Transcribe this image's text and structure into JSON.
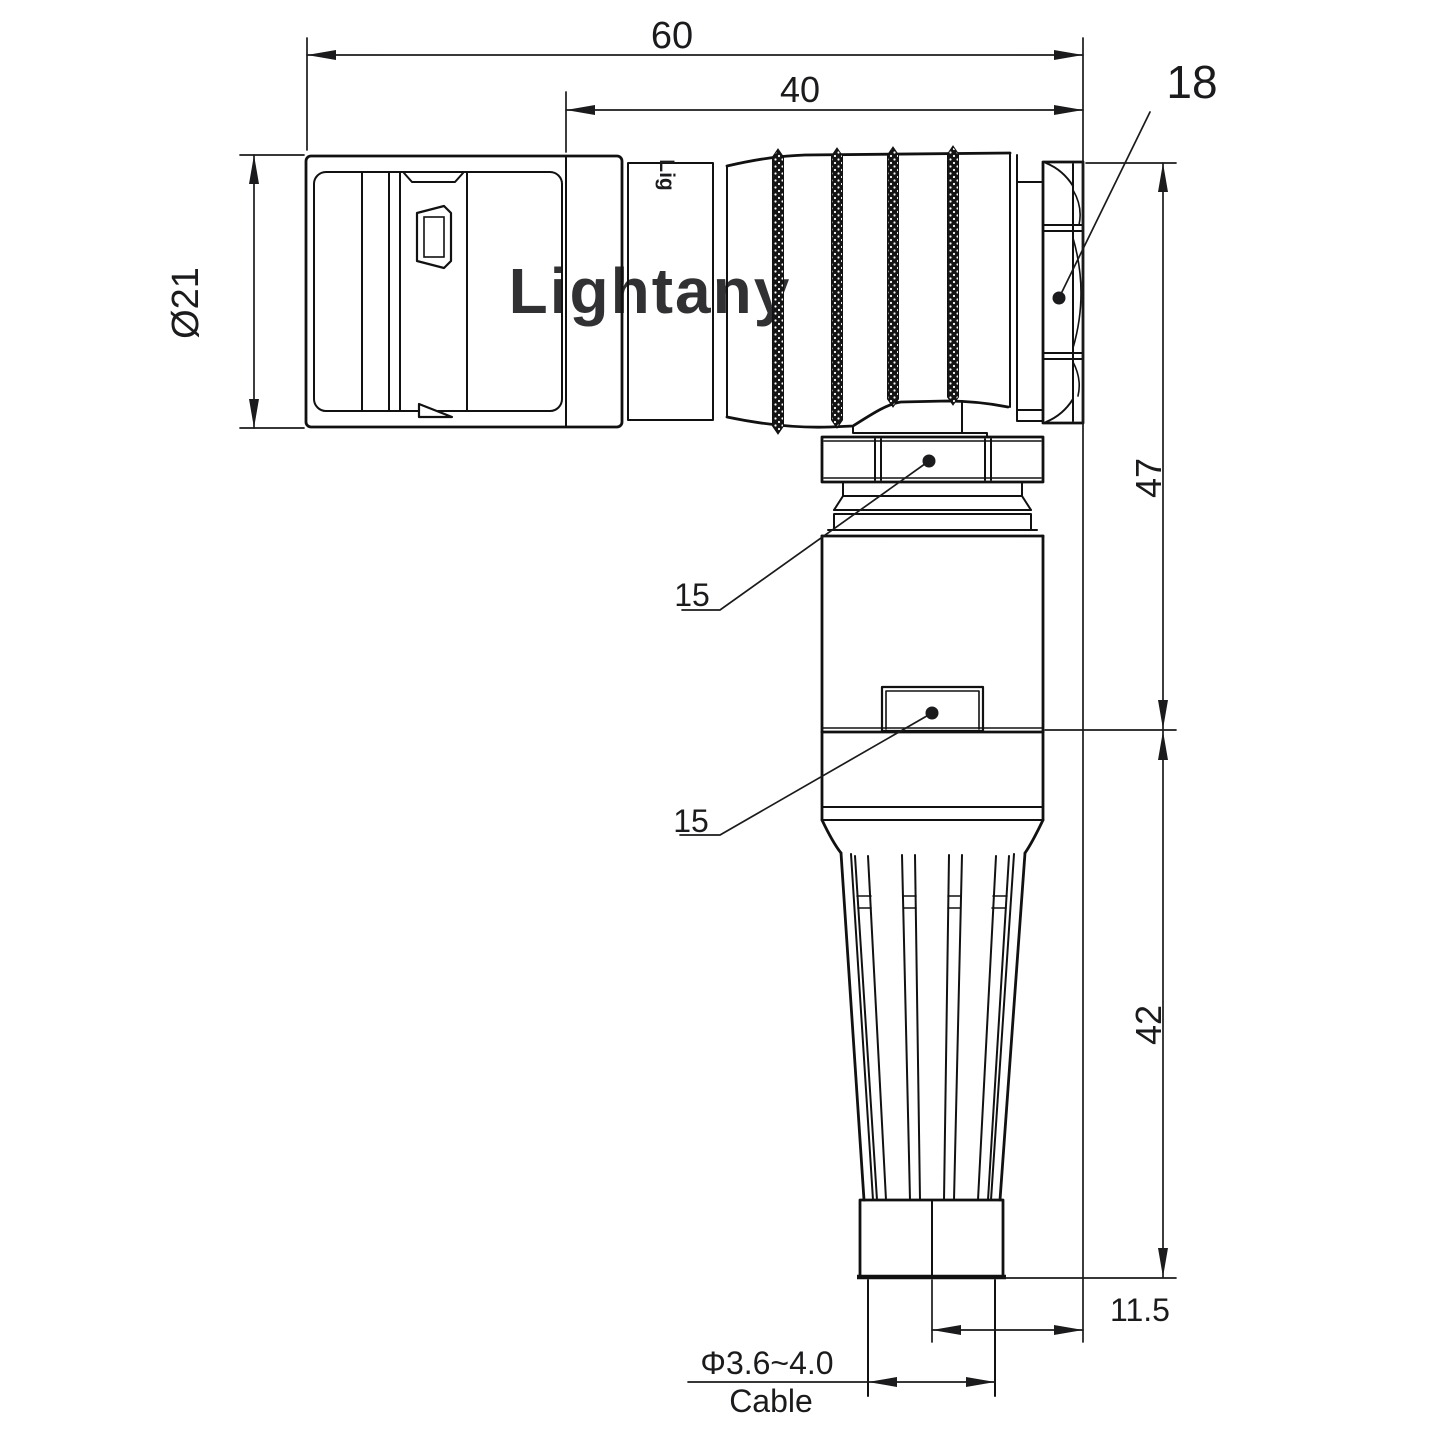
{
  "page": {
    "background": "#ffffff",
    "line_color": "#111111",
    "text_color": "#1b1b1d",
    "watermark_color": "#f2c1be"
  },
  "watermark": {
    "text": "Lightany"
  },
  "part_marking": {
    "text": "Lig"
  },
  "dimensions": {
    "overall_length": {
      "value": "60"
    },
    "rear_length": {
      "value": "40"
    },
    "nut_across_flats": {
      "value": "18"
    },
    "front_diameter": {
      "value": "Ø21"
    },
    "elbow_height": {
      "value": "47"
    },
    "collar_nut_leader": {
      "value": "15"
    },
    "body_leader": {
      "value": "15"
    },
    "lower_height": {
      "value": "42"
    },
    "cable_offset": {
      "value": "11.5"
    },
    "cable_diameter": {
      "value": "Φ3.6~4.0"
    },
    "cable_label": {
      "value": "Cable"
    }
  }
}
